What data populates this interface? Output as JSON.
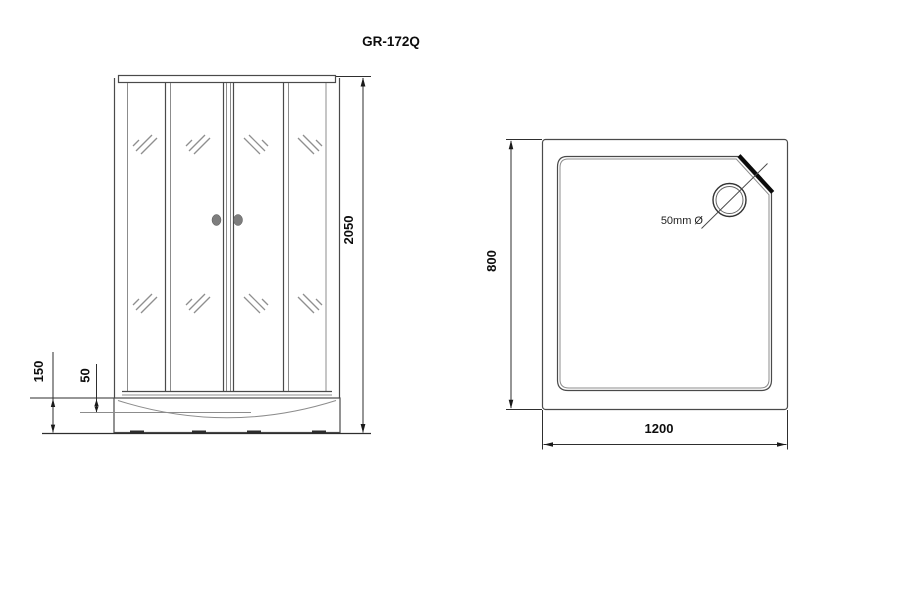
{
  "title": "GR-172Q",
  "front_view": {
    "label": "front view of shower cabin",
    "height_mm": "2050",
    "tray_height_mm": "150",
    "basin_depth_mm": "50"
  },
  "top_view": {
    "label": "top view of shower tray",
    "depth_mm": "800",
    "width_mm": "1200",
    "drain_diameter": "50mm Ø"
  }
}
